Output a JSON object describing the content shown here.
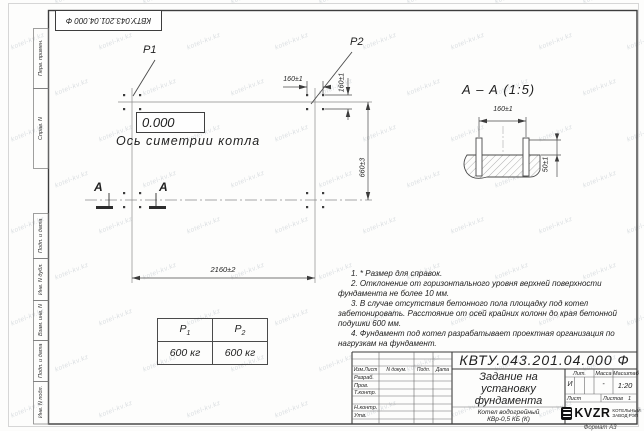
{
  "watermark": {
    "text": "kotel-kv.kz"
  },
  "stamp_top": {
    "doc_number": "КВТУ.043.201.04.000 Ф"
  },
  "margin_labels": {
    "perv_primen": "Перв. примен.",
    "sprav_n": "Справ. N",
    "podp_data_1": "Подп. и дата",
    "inv_dubl": "Инв. N дубл.",
    "vzam_inv": "Взам. инв. N",
    "podp_data_2": "Подп. и дата",
    "inv_podl": "Инв. N подл."
  },
  "plan": {
    "p1_label": "P1",
    "p2_label": "P2",
    "elevation": "0.000",
    "axis_label": "Ось симетрии котла",
    "dim_160_h": "160±1",
    "dim_160_v": "160±1",
    "dim_660": "660±3",
    "dim_2160": "2160±2",
    "section_letter": "А"
  },
  "section_view": {
    "title": "А – А (1:5)",
    "dim_160": "160±1",
    "dim_50": "50±1"
  },
  "load_table": {
    "headers": [
      {
        "base": "P",
        "sub": "1"
      },
      {
        "base": "P",
        "sub": "2"
      }
    ],
    "values": [
      "600 кг",
      "600 кг"
    ]
  },
  "notes": {
    "items": [
      "1. * Размер для справок.",
      "2. Отклонение от горизонтального уровня верхней поверхности фундамента не более 10 мм.",
      "3. В случае отсутствия бетонного пола площадку под котел забетонировать. Расстояние от осей крайних колонн до края бетонной подушки 600 мм.",
      "4. Фундамент под котел разрабатывает проектная организация по нагрузкам на фундамент."
    ]
  },
  "title_block": {
    "doc_number": "КВТУ.043.201.04.000 Ф",
    "title_line1": "Задание на",
    "title_line2": "установку",
    "title_line3": "фундамента",
    "product_line1": "Котел водогрейный",
    "product_line2": "КВр-0,5 КБ (К)",
    "col_izm": "Изм.Лист",
    "col_doc": "N докум.",
    "col_podp": "Подп.",
    "col_data": "Дата",
    "row_razrab": "Разраб.",
    "row_prov": "Пров.",
    "row_tkontr": "Т.контр.",
    "row_nkontr": "Н.контр.",
    "row_utv": "Утв.",
    "lit_label": "Лит.",
    "massa_label": "Масса",
    "masshtab_label": "Масштаб",
    "lit_value": "И",
    "massa_value": "-",
    "masshtab_value": "1:20",
    "list_label": "Лист",
    "listov_label": "Листов",
    "listov_value": "1",
    "logo_text": "KVZR",
    "logo_caption1": "КОТЕЛЬНЫЙ",
    "logo_caption2": "ЗАВОД РЭП",
    "format_note": "Формат А3"
  }
}
